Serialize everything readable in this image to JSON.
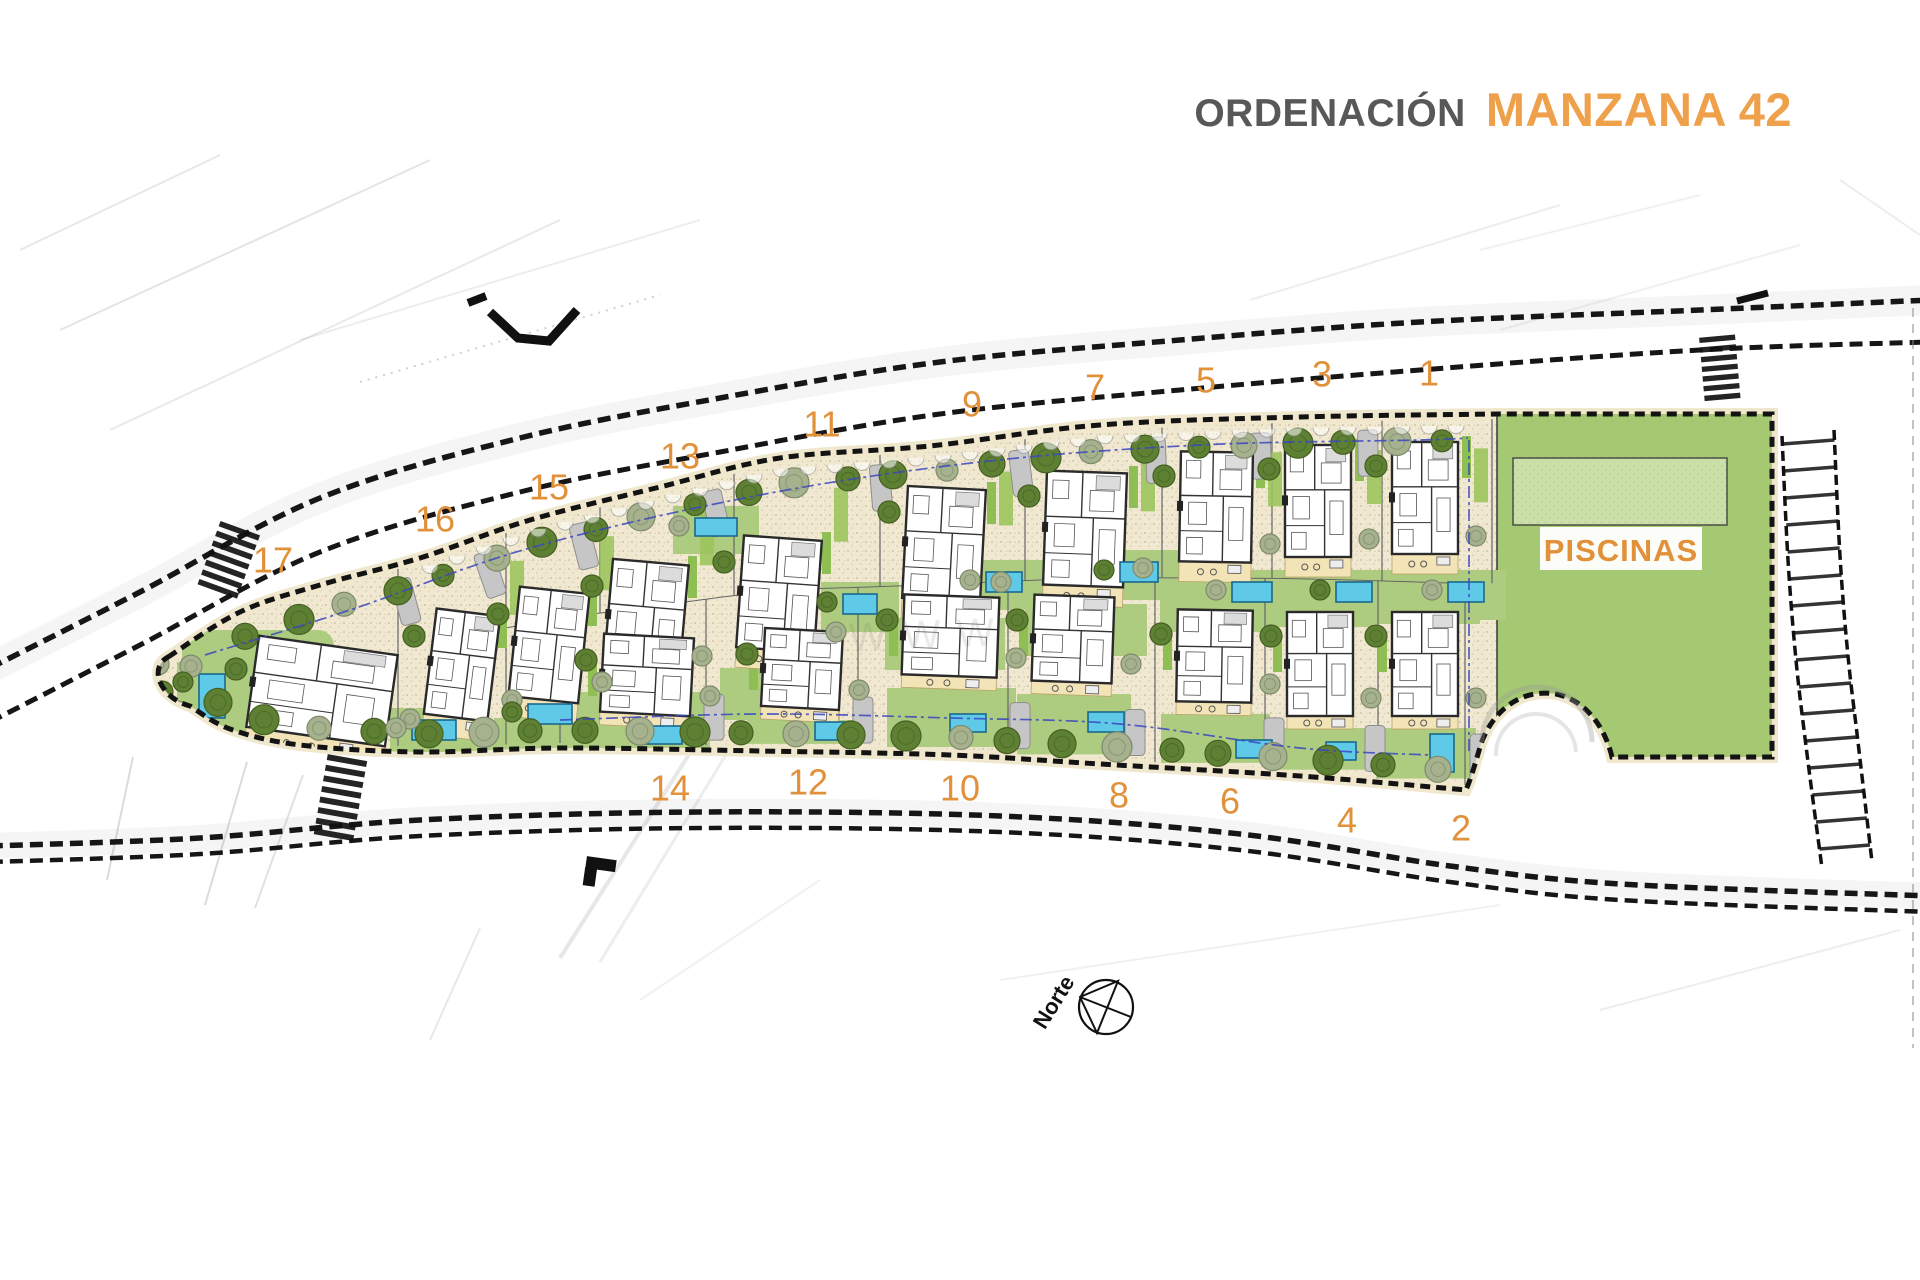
{
  "title": {
    "prefix": "ORDENACIÓN",
    "highlight": "MANZANA 42"
  },
  "labels": {
    "pools_area": "PISCINAS",
    "north": "Norte",
    "watermark": "WWW"
  },
  "colors": {
    "accent_orange": "#E2913B",
    "title_gray": "#58585A",
    "title_orange": "#EFA04B",
    "sand": "#F0E8D0",
    "sand_dot": "#C9BB92",
    "lawn": "#AECC80",
    "green_area": "#A5C973",
    "pool_area_light": "#CBDFA8",
    "pool_blue": "#5FC9E8",
    "tree_dark": "#5E8033",
    "tree_light": "#A6B28E",
    "road_line": "#161616",
    "setback_blue": "#3946C0",
    "house_fill": "#FFFFFF",
    "house_stroke": "#2A2A2A",
    "terrace": "#F2E4B6",
    "driveway": "#C6C6C6",
    "sidewalk": "#EFE7CB"
  },
  "plots": [
    {
      "number": "17",
      "row": "top",
      "label": {
        "x": 273,
        "y": 560
      },
      "house": {
        "x": 252,
        "y": 645,
        "w": 140,
        "h": 92,
        "rot": 8
      },
      "pool": {
        "x": 199,
        "y": 674,
        "w": 26,
        "h": 44
      }
    },
    {
      "number": "16",
      "row": "top",
      "label": {
        "x": 435,
        "y": 519
      },
      "house": {
        "x": 430,
        "y": 612,
        "w": 64,
        "h": 106,
        "rot": 7
      },
      "pool": {
        "x": 412,
        "y": 720,
        "w": 44,
        "h": 20
      }
    },
    {
      "number": "15",
      "row": "top",
      "label": {
        "x": 549,
        "y": 487
      },
      "house": {
        "x": 514,
        "y": 590,
        "w": 70,
        "h": 110,
        "rot": 6
      },
      "pool": {
        "x": 528,
        "y": 704,
        "w": 44,
        "h": 20
      }
    },
    {
      "number": "13",
      "row": "top",
      "label": {
        "x": 680,
        "y": 456
      },
      "house": {
        "x": 608,
        "y": 562,
        "w": 76,
        "h": 112,
        "rot": 5
      },
      "pool": {
        "x": 695,
        "y": 518,
        "w": 42,
        "h": 18
      }
    },
    {
      "number": "11",
      "row": "top",
      "label": {
        "x": 822,
        "y": 424
      },
      "house": {
        "x": 740,
        "y": 538,
        "w": 78,
        "h": 112,
        "rot": 4
      },
      "pool": {
        "x": 843,
        "y": 594,
        "w": 34,
        "h": 20
      }
    },
    {
      "number": "9",
      "row": "top",
      "label": {
        "x": 972,
        "y": 404
      },
      "house": {
        "x": 905,
        "y": 488,
        "w": 78,
        "h": 112,
        "rot": 3
      },
      "pool": {
        "x": 986,
        "y": 572,
        "w": 36,
        "h": 20
      }
    },
    {
      "number": "7",
      "row": "top",
      "label": {
        "x": 1095,
        "y": 387
      },
      "house": {
        "x": 1045,
        "y": 472,
        "w": 80,
        "h": 114,
        "rot": 2
      },
      "pool": {
        "x": 1120,
        "y": 562,
        "w": 38,
        "h": 20
      }
    },
    {
      "number": "5",
      "row": "top",
      "label": {
        "x": 1206,
        "y": 380
      },
      "house": {
        "x": 1180,
        "y": 452,
        "w": 72,
        "h": 110,
        "rot": 1
      },
      "pool": {
        "x": 1232,
        "y": 582,
        "w": 40,
        "h": 20
      }
    },
    {
      "number": "3",
      "row": "top",
      "label": {
        "x": 1322,
        "y": 374
      },
      "house": {
        "x": 1285,
        "y": 445,
        "w": 66,
        "h": 112,
        "rot": 0
      },
      "pool": {
        "x": 1336,
        "y": 582,
        "w": 36,
        "h": 20
      }
    },
    {
      "number": "1",
      "row": "top",
      "label": {
        "x": 1429,
        "y": 373
      },
      "house": {
        "x": 1392,
        "y": 442,
        "w": 66,
        "h": 112,
        "rot": 0
      },
      "pool": {
        "x": 1448,
        "y": 582,
        "w": 36,
        "h": 20
      }
    },
    {
      "number": "14",
      "row": "bottom",
      "label": {
        "x": 670,
        "y": 788
      },
      "house": {
        "x": 602,
        "y": 636,
        "w": 90,
        "h": 78,
        "rot": 3
      },
      "pool": {
        "x": 646,
        "y": 726,
        "w": 36,
        "h": 18
      }
    },
    {
      "number": "12",
      "row": "bottom",
      "label": {
        "x": 808,
        "y": 782
      },
      "house": {
        "x": 763,
        "y": 630,
        "w": 78,
        "h": 78,
        "rot": 3
      },
      "pool": {
        "x": 815,
        "y": 722,
        "w": 36,
        "h": 18
      }
    },
    {
      "number": "10",
      "row": "bottom",
      "label": {
        "x": 960,
        "y": 788
      },
      "house": {
        "x": 903,
        "y": 596,
        "w": 95,
        "h": 80,
        "rot": 2
      },
      "pool": {
        "x": 950,
        "y": 714,
        "w": 36,
        "h": 18
      }
    },
    {
      "number": "8",
      "row": "bottom",
      "label": {
        "x": 1119,
        "y": 795
      },
      "house": {
        "x": 1033,
        "y": 596,
        "w": 80,
        "h": 86,
        "rot": 2
      },
      "pool": {
        "x": 1088,
        "y": 712,
        "w": 36,
        "h": 20
      }
    },
    {
      "number": "6",
      "row": "bottom",
      "label": {
        "x": 1230,
        "y": 801
      },
      "house": {
        "x": 1177,
        "y": 610,
        "w": 75,
        "h": 92,
        "rot": 1
      },
      "pool": {
        "x": 1236,
        "y": 740,
        "w": 36,
        "h": 18
      }
    },
    {
      "number": "4",
      "row": "bottom",
      "label": {
        "x": 1347,
        "y": 820
      },
      "house": {
        "x": 1287,
        "y": 612,
        "w": 66,
        "h": 104,
        "rot": 0
      },
      "pool": {
        "x": 1326,
        "y": 742,
        "w": 30,
        "h": 18
      }
    },
    {
      "number": "2",
      "row": "bottom",
      "label": {
        "x": 1461,
        "y": 828
      },
      "house": {
        "x": 1392,
        "y": 612,
        "w": 66,
        "h": 104,
        "rot": 0
      },
      "pool": {
        "x": 1430,
        "y": 734,
        "w": 24,
        "h": 38
      }
    }
  ]
}
